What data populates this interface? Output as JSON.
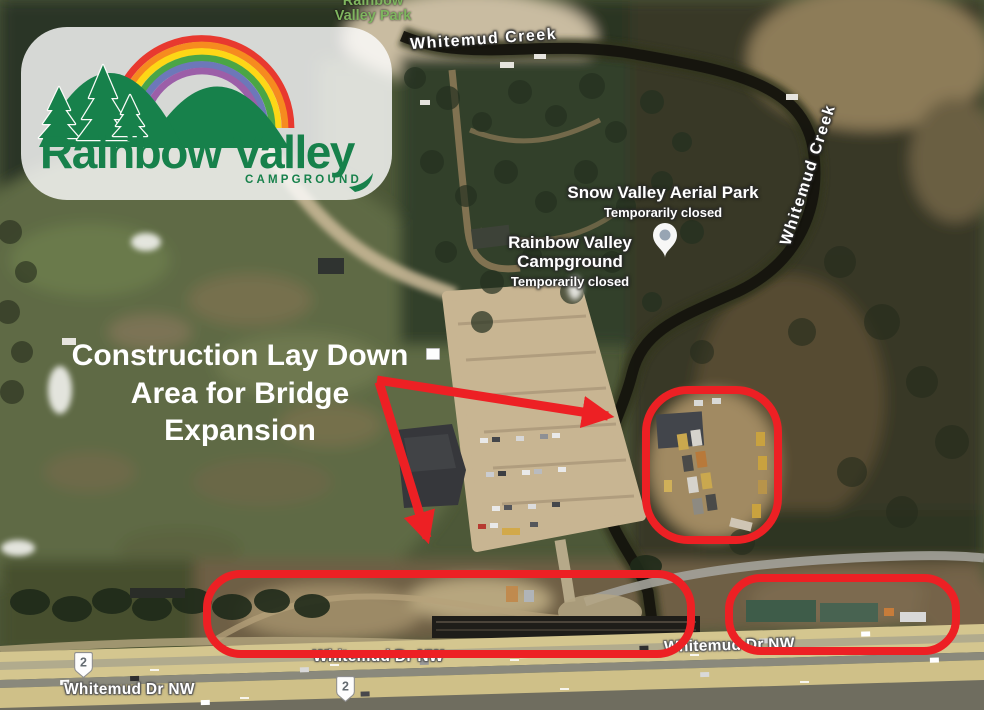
{
  "colors": {
    "annotation_red": "#ed2024",
    "annotation_text": "#ffffff",
    "logo_green": "#17814b",
    "park_label_green": "#7fb55f",
    "rainbow_bands": [
      "#e8392f",
      "#f68b1f",
      "#fdd716",
      "#4aa546",
      "#6d78b9",
      "#9c5fa8"
    ]
  },
  "logo": {
    "title": "Rainbow Valley",
    "subtitle": "CAMPGROUND"
  },
  "annotation": {
    "lines": [
      "Construction Lay Down",
      "Area for Bridge",
      "Expansion"
    ]
  },
  "map_labels": {
    "park": {
      "line1": "Rainbow",
      "line2": "Valley Park"
    },
    "creek_top": "Whitemud Creek",
    "creek_side": "Whitemud Creek",
    "poi_aerial_park": {
      "name": "Snow Valley Aerial Park",
      "status": "Temporarily closed"
    },
    "poi_campground": {
      "line1": "Rainbow Valley",
      "line2": "Campground",
      "status": "Temporarily closed"
    },
    "road_left": "Whitemud Dr NW",
    "road_center": "Whitemud Dr NW",
    "road_right": "Whitemud Dr NW",
    "shield_left": "2",
    "shield_right": "2"
  }
}
